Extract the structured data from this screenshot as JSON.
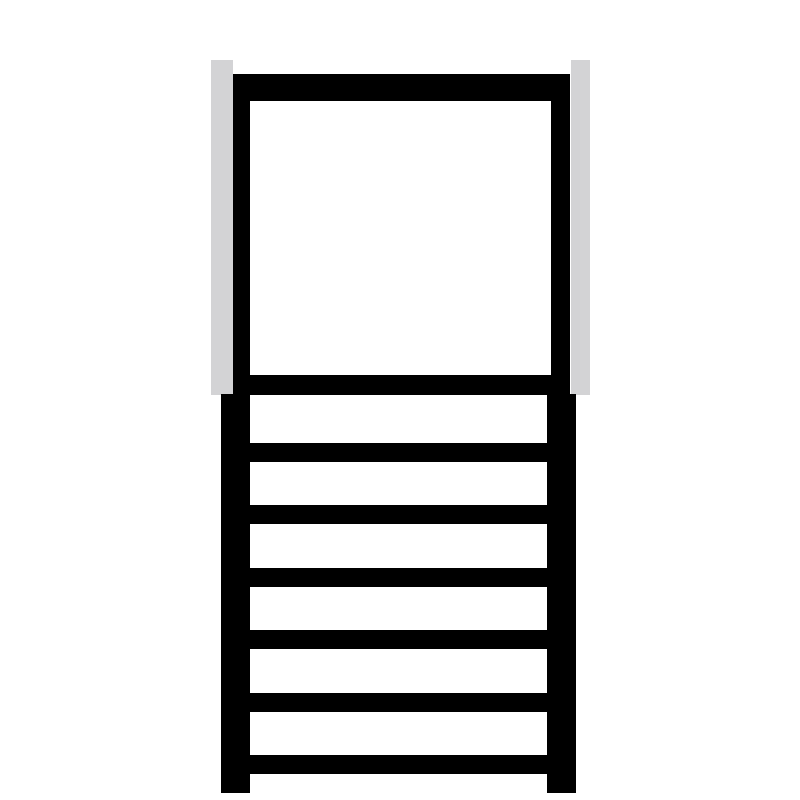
{
  "figure": {
    "name": "ladder-with-square-frame-pictogram",
    "description": "Black pictogram of a step ladder: a large hollow square frame at the top flanked by two light-gray vertical posts, standing on a ladder section with six horizontal rungs between two thick rails.",
    "colors": {
      "ink": "#000000",
      "post": "#d3d3d5",
      "background": "#ffffff"
    },
    "rungs": {
      "count": 6,
      "y_positions": [
        443,
        505,
        568,
        630,
        693,
        755
      ],
      "height": 19
    }
  }
}
